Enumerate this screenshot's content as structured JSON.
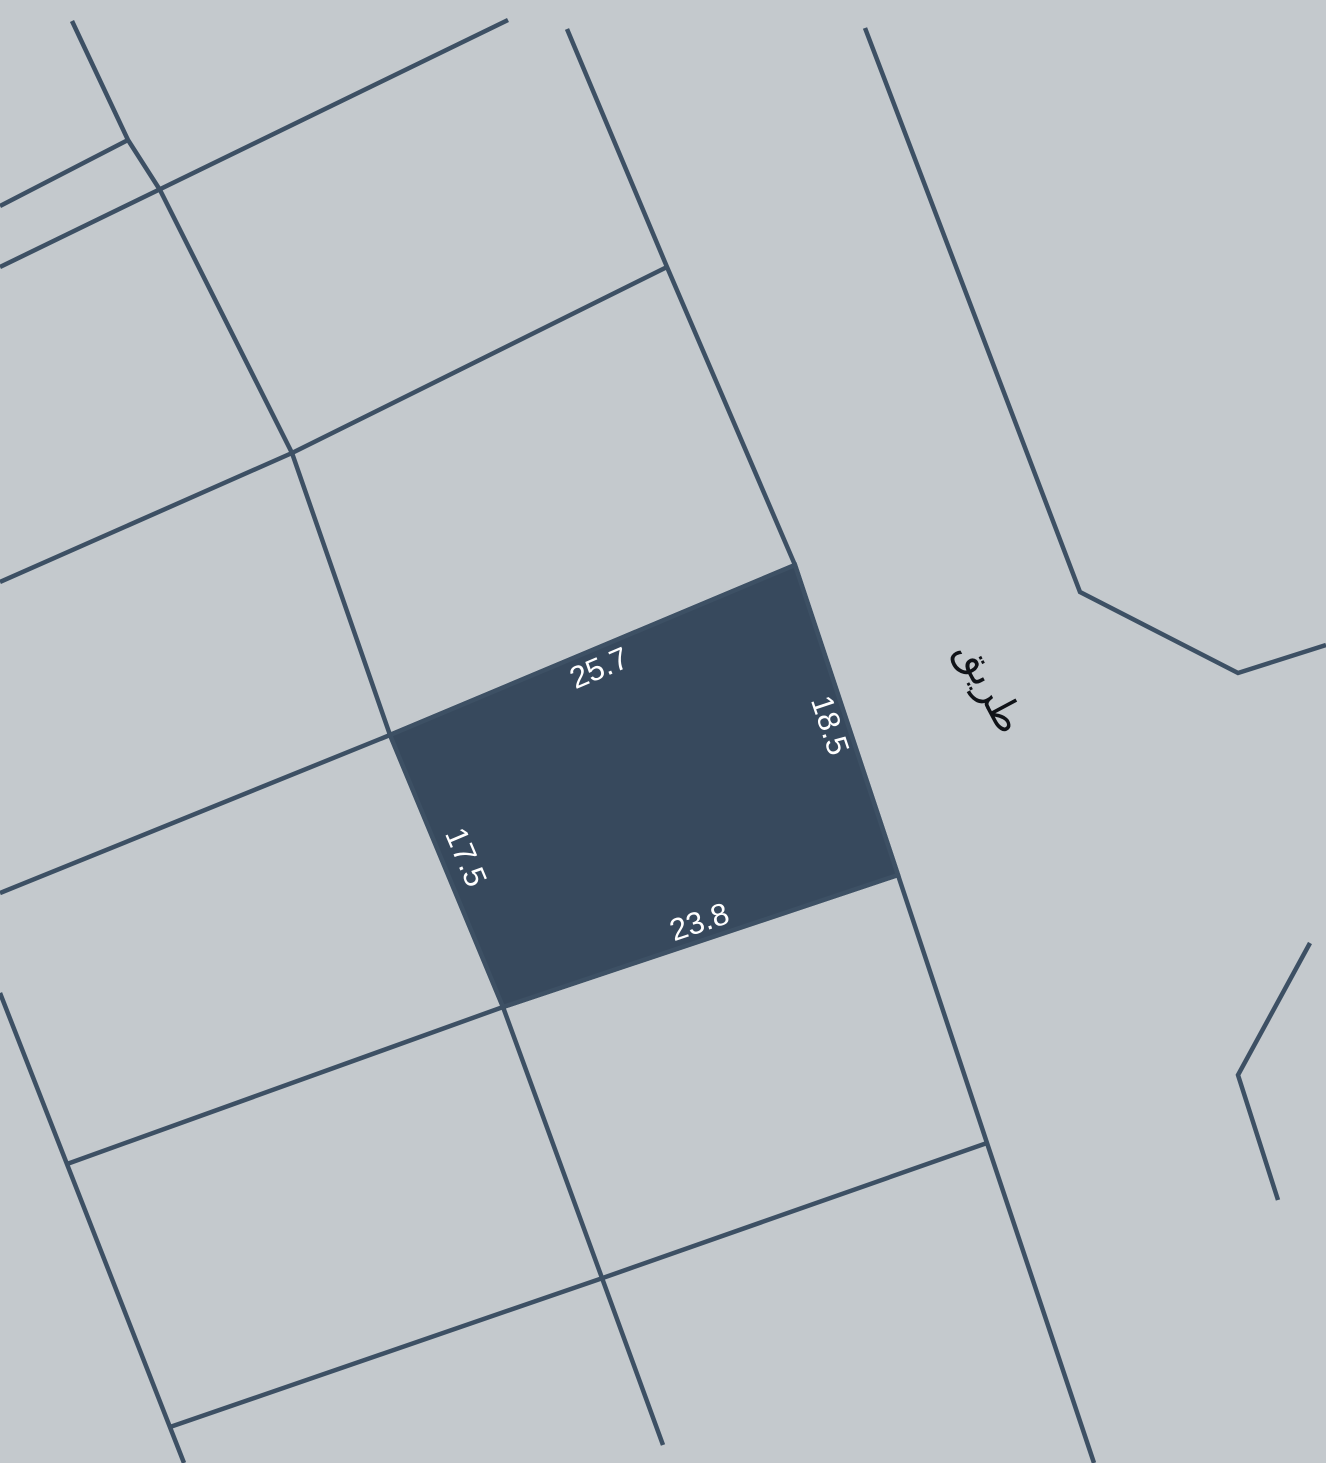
{
  "map": {
    "background_color": "#c4c9cd",
    "line_color": "#3d5064",
    "line_width": 4.5,
    "highlighted_parcel": {
      "fill_color": "#37495d",
      "points": [
        [
          390,
          735
        ],
        [
          795,
          565
        ],
        [
          898,
          875
        ],
        [
          503,
          1007
        ]
      ]
    },
    "boundary_lines": [
      {
        "name": "left-road-line",
        "points": [
          [
            72,
            21
          ],
          [
            128,
            140
          ],
          [
            160,
            190
          ],
          [
            292,
            453
          ],
          [
            390,
            735
          ],
          [
            503,
            1007
          ],
          [
            663,
            1445
          ]
        ]
      },
      {
        "name": "top-left-stub-line",
        "points": [
          [
            0,
            206
          ],
          [
            128,
            140
          ]
        ]
      },
      {
        "name": "upper-left-road-line",
        "points": [
          [
            0,
            267
          ],
          [
            508,
            20
          ]
        ]
      },
      {
        "name": "mid-left-road-line",
        "points": [
          [
            0,
            582
          ],
          [
            292,
            453
          ],
          [
            667,
            267
          ]
        ]
      },
      {
        "name": "center-road-line",
        "points": [
          [
            567,
            29
          ],
          [
            667,
            267
          ],
          [
            795,
            565
          ],
          [
            898,
            875
          ],
          [
            987,
            1143
          ],
          [
            1094,
            1463
          ]
        ]
      },
      {
        "name": "parcel-top-line",
        "points": [
          [
            0,
            893
          ],
          [
            390,
            735
          ],
          [
            795,
            565
          ]
        ]
      },
      {
        "name": "parcel-bottom-line",
        "points": [
          [
            67,
            1164
          ],
          [
            503,
            1007
          ],
          [
            898,
            875
          ]
        ]
      },
      {
        "name": "lower-cross-line",
        "points": [
          [
            170,
            1427
          ],
          [
            597,
            1280
          ],
          [
            987,
            1143
          ]
        ]
      },
      {
        "name": "bottom-left-road-line",
        "points": [
          [
            0,
            993
          ],
          [
            184,
            1463
          ]
        ]
      },
      {
        "name": "right-road-line",
        "points": [
          [
            865,
            28
          ],
          [
            1080,
            592
          ],
          [
            1238,
            673
          ],
          [
            1326,
            645
          ]
        ]
      },
      {
        "name": "right-chevron-line",
        "points": [
          [
            1310,
            943
          ],
          [
            1238,
            1075
          ],
          [
            1278,
            1200
          ]
        ]
      }
    ],
    "dimension_labels": [
      {
        "name": "dimension-top",
        "text": "25.7",
        "x": 600,
        "y": 670,
        "rotate": -23,
        "color": "#ffffff",
        "size": 31
      },
      {
        "name": "dimension-right",
        "text": "18.5",
        "x": 828,
        "y": 726,
        "rotate": 71.5,
        "color": "#ffffff",
        "size": 31
      },
      {
        "name": "dimension-left",
        "text": "17.5",
        "x": 464,
        "y": 858,
        "rotate": 67,
        "color": "#ffffff",
        "size": 31
      },
      {
        "name": "dimension-bottom",
        "text": "23.8",
        "x": 700,
        "y": 924,
        "rotate": -18.5,
        "color": "#ffffff",
        "size": 31
      }
    ],
    "road_label": {
      "name": "road-name-label",
      "text": "طريق",
      "x": 988,
      "y": 688,
      "rotate": 62,
      "color": "#101318",
      "size": 40
    }
  }
}
